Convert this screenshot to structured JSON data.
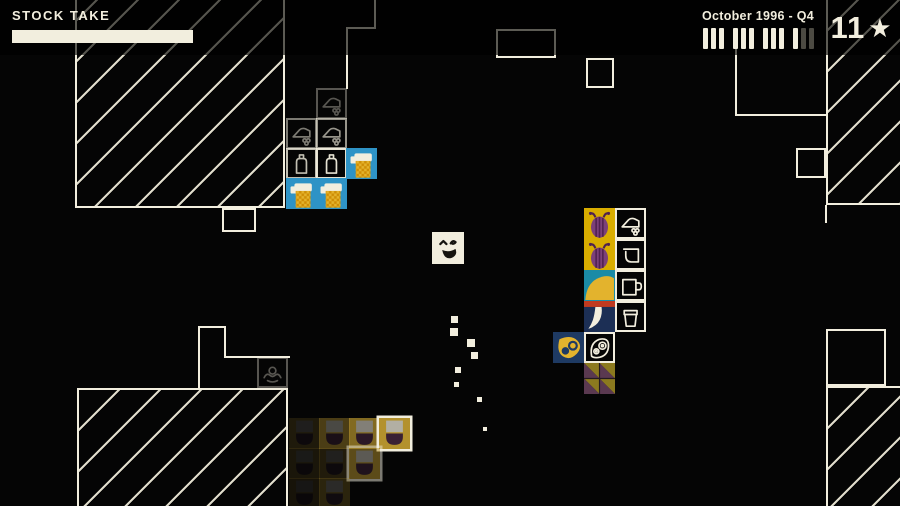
{
  "hud": {
    "stock_take_label": "STOCK TAKE",
    "progress_percent": 100,
    "date_label": "October 1996 - Q4",
    "quarter_tally": [
      [
        1,
        1,
        1
      ],
      [
        1,
        1,
        1
      ],
      [
        1,
        1,
        1
      ],
      [
        1,
        0,
        0
      ]
    ],
    "score": "11",
    "star_icon": "★"
  },
  "palette": {
    "cream": "#f2eede",
    "cream_t": "rgba(242,238,220,0.92)",
    "blue": "#2e93c6",
    "yellow": "#e3b32d",
    "orange": "#cf8d05",
    "gold": "#d9ad00",
    "purple": "#7b4079",
    "darkpurple": "#4f2150",
    "teal": "#1b8ba6",
    "navy": "#1c2f55",
    "navy2": "#1e3a63",
    "red": "#c03a20",
    "winegold": "#b3912d",
    "jargray": "#b2afa3",
    "wine": "#3a2034",
    "trigold": "#8c7a1f",
    "tripurple": "#5a3950",
    "tile_gap": "#241a20"
  },
  "world": {
    "character": {
      "x": 432,
      "y": 232,
      "size": 32,
      "expression": "laughing-face"
    },
    "walls": [
      {
        "kind": "hatch",
        "x": 75,
        "y": -20,
        "w": 210,
        "h": 228,
        "borders": "lrb"
      },
      {
        "kind": "outline",
        "x": 222,
        "y": 208,
        "w": 34,
        "h": 24
      },
      {
        "kind": "vline",
        "x": 374,
        "y": -4,
        "len": 33
      },
      {
        "kind": "hline",
        "x": 346,
        "y": 27,
        "len": 30
      },
      {
        "kind": "vline",
        "x": 346,
        "y": 27,
        "len": 62
      },
      {
        "kind": "outline",
        "x": 496,
        "y": 29,
        "w": 60,
        "h": 29
      },
      {
        "kind": "outline",
        "x": 586,
        "y": 58,
        "w": 28,
        "h": 30
      },
      {
        "kind": "vline",
        "x": 735,
        "y": 45,
        "len": 71
      },
      {
        "kind": "hline",
        "x": 735,
        "y": 114,
        "len": 92
      },
      {
        "kind": "hatch",
        "x": 826,
        "y": -10,
        "w": 80,
        "h": 215,
        "borders": "lb"
      },
      {
        "kind": "outline",
        "x": 796,
        "y": 148,
        "w": 30,
        "h": 30
      },
      {
        "kind": "vline",
        "x": 825,
        "y": 205,
        "len": 18
      },
      {
        "kind": "outline",
        "x": 826,
        "y": 329,
        "w": 60,
        "h": 57
      },
      {
        "kind": "hatch",
        "x": 826,
        "y": 386,
        "w": 80,
        "h": 122,
        "borders": "lt"
      },
      {
        "kind": "outline",
        "x": 796,
        "y": 449,
        "w": 28,
        "h": 58,
        "borders": "ltr"
      },
      {
        "kind": "hatch",
        "x": 77,
        "y": 388,
        "w": 211,
        "h": 120,
        "borders": "tlr"
      },
      {
        "kind": "vline",
        "x": 198,
        "y": 326,
        "len": 63
      },
      {
        "kind": "hline",
        "x": 198,
        "y": 326,
        "len": 28
      },
      {
        "kind": "vline",
        "x": 224,
        "y": 326,
        "len": 31
      },
      {
        "kind": "hline",
        "x": 224,
        "y": 356,
        "len": 66
      }
    ],
    "tiles": [
      {
        "type": "skate",
        "variant": "outline",
        "x": 316,
        "y": 88,
        "opacity": 0.35
      },
      {
        "type": "skate",
        "variant": "outline",
        "x": 286,
        "y": 118,
        "opacity": 0.5
      },
      {
        "type": "skate",
        "variant": "outline",
        "x": 316,
        "y": 118,
        "opacity": 0.62
      },
      {
        "type": "flask",
        "variant": "outline",
        "x": 286,
        "y": 148,
        "opacity": 0.8
      },
      {
        "type": "flask",
        "variant": "outline",
        "x": 316,
        "y": 148,
        "opacity": 0.95
      },
      {
        "type": "beer-mug",
        "variant": "solid",
        "x": 346,
        "y": 148,
        "opacity": 1
      },
      {
        "type": "beer-mug",
        "variant": "solid",
        "x": 286,
        "y": 178,
        "opacity": 1
      },
      {
        "type": "beer-mug",
        "variant": "solid",
        "x": 316,
        "y": 178,
        "opacity": 1
      },
      {
        "type": "beet",
        "variant": "solid",
        "x": 584,
        "y": 208,
        "opacity": 1
      },
      {
        "type": "skate",
        "variant": "outline",
        "x": 615,
        "y": 208,
        "opacity": 1
      },
      {
        "type": "beet",
        "variant": "solid",
        "x": 584,
        "y": 239,
        "opacity": 1
      },
      {
        "type": "jug",
        "variant": "outline",
        "x": 615,
        "y": 239,
        "opacity": 1
      },
      {
        "type": "banana",
        "variant": "solid",
        "x": 584,
        "y": 270,
        "opacity": 1
      },
      {
        "type": "mug",
        "variant": "outline",
        "x": 615,
        "y": 270,
        "opacity": 1
      },
      {
        "type": "tusk",
        "variant": "solid",
        "x": 584,
        "y": 301,
        "opacity": 1
      },
      {
        "type": "cup",
        "variant": "outline",
        "x": 615,
        "y": 301,
        "opacity": 1
      },
      {
        "type": "paw",
        "variant": "solid",
        "x": 553,
        "y": 332,
        "opacity": 1
      },
      {
        "type": "leaf",
        "variant": "outline",
        "x": 584,
        "y": 332,
        "opacity": 1
      },
      {
        "type": "triangles",
        "variant": "solid",
        "x": 584,
        "y": 363,
        "opacity": 1
      },
      {
        "type": "squid",
        "variant": "outline",
        "x": 257,
        "y": 357,
        "opacity": 0.35
      },
      {
        "type": "jar",
        "variant": "solid",
        "x": 289,
        "y": 418,
        "opacity": 0.15
      },
      {
        "type": "jar",
        "variant": "solid",
        "x": 319,
        "y": 418,
        "opacity": 0.4
      },
      {
        "type": "jar",
        "variant": "solid",
        "x": 349,
        "y": 418,
        "opacity": 0.72
      },
      {
        "type": "jar",
        "variant": "solid",
        "x": 379,
        "y": 418,
        "opacity": 1,
        "lit": true
      },
      {
        "type": "jar",
        "variant": "solid",
        "x": 289,
        "y": 448,
        "opacity": 0.12
      },
      {
        "type": "jar",
        "variant": "solid",
        "x": 319,
        "y": 448,
        "opacity": 0.16
      },
      {
        "type": "jar",
        "variant": "solid",
        "x": 349,
        "y": 448,
        "opacity": 0.5,
        "lit": true
      },
      {
        "type": "jar",
        "variant": "solid",
        "x": 289,
        "y": 478,
        "opacity": 0.1
      },
      {
        "type": "jar",
        "variant": "solid",
        "x": 319,
        "y": 478,
        "opacity": 0.22
      }
    ],
    "trail_dots": [
      {
        "x": 451,
        "y": 316,
        "s": 7
      },
      {
        "x": 450,
        "y": 328,
        "s": 8
      },
      {
        "x": 467,
        "y": 339,
        "s": 8
      },
      {
        "x": 471,
        "y": 352,
        "s": 7
      },
      {
        "x": 455,
        "y": 367,
        "s": 6
      },
      {
        "x": 454,
        "y": 382,
        "s": 5
      },
      {
        "x": 477,
        "y": 397,
        "s": 5
      },
      {
        "x": 483,
        "y": 427,
        "s": 4
      }
    ]
  }
}
